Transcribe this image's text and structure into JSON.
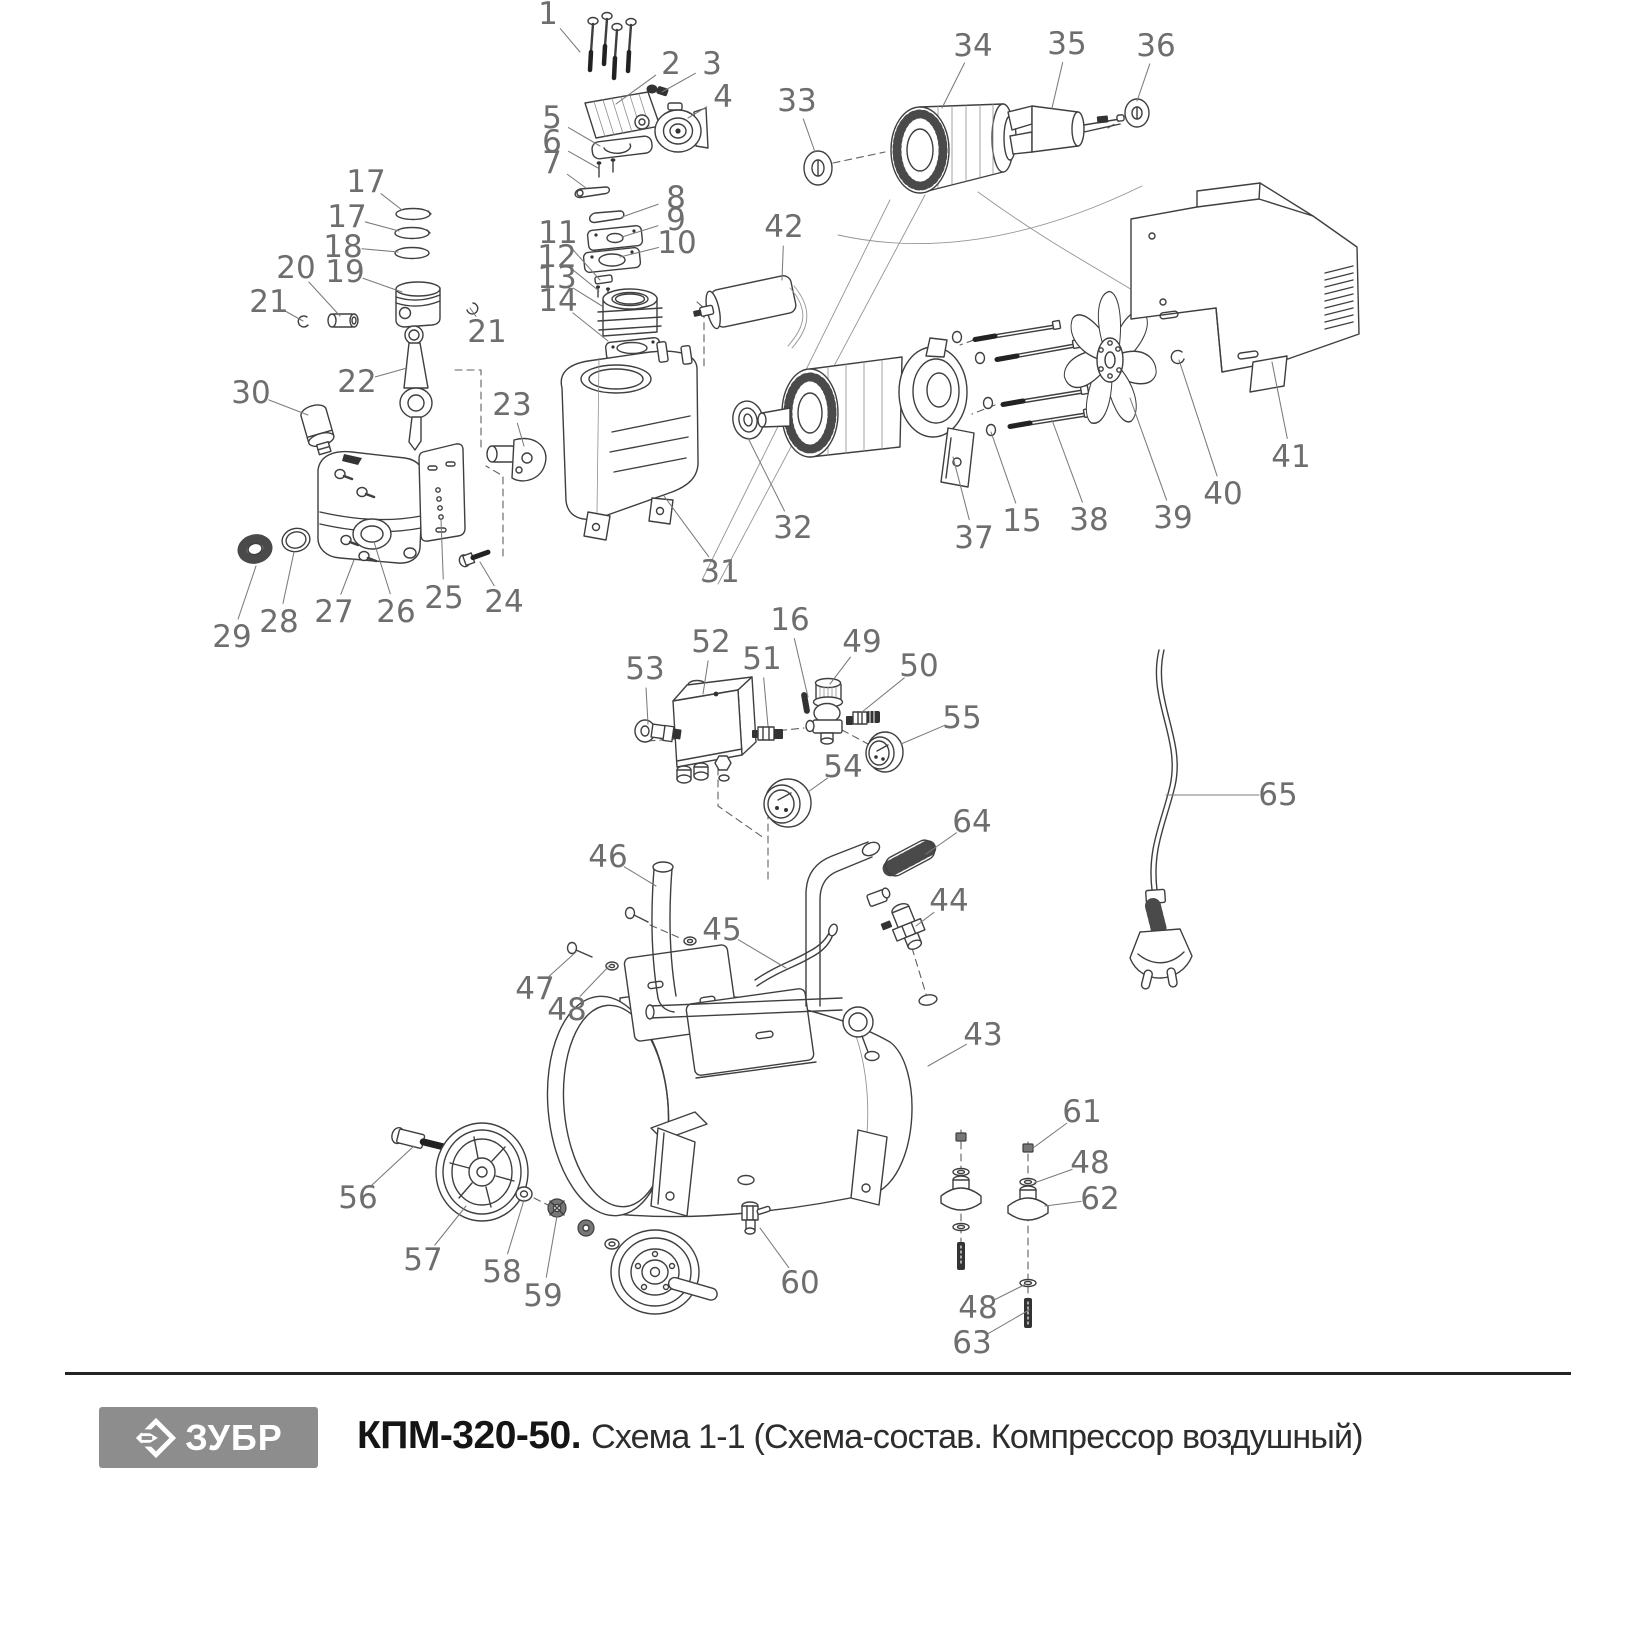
{
  "footer": {
    "brand": "ЗУБР",
    "logo_icon": "zubr-diamond-arrow-icon",
    "model": "КПМ-320-50.",
    "subtitle": "Схема 1-1 (Схема-состав. Компрессор воздушный)"
  },
  "colors": {
    "line_art": "#3f3f3f",
    "label_text": "#6e6e6e",
    "leader_line": "#7b7b7b",
    "logo_background": "#8d8d8d",
    "title_text": "#151515"
  },
  "diagram": {
    "kind": "exploded-parts-diagram",
    "subject": "Компрессор воздушный КПМ-320-50",
    "labels": [
      {
        "t": "1",
        "x": 548,
        "y": 14,
        "tx": 580,
        "ty": 52
      },
      {
        "t": "2",
        "x": 671,
        "y": 64,
        "tx": 616,
        "ty": 104
      },
      {
        "t": "3",
        "x": 712,
        "y": 64,
        "tx": 662,
        "ty": 92
      },
      {
        "t": "4",
        "x": 723,
        "y": 97,
        "tx": 688,
        "ty": 118
      },
      {
        "t": "5",
        "x": 552,
        "y": 118,
        "tx": 600,
        "ty": 146
      },
      {
        "t": "6",
        "x": 552,
        "y": 142,
        "tx": 598,
        "ty": 168
      },
      {
        "t": "7",
        "x": 552,
        "y": 163,
        "tx": 586,
        "ty": 188
      },
      {
        "t": "8",
        "x": 676,
        "y": 198,
        "tx": 622,
        "ty": 217
      },
      {
        "t": "9",
        "x": 676,
        "y": 220,
        "tx": 622,
        "ty": 237
      },
      {
        "t": "10",
        "x": 677,
        "y": 243,
        "tx": 620,
        "ty": 257
      },
      {
        "t": "11",
        "x": 558,
        "y": 233,
        "tx": 600,
        "ty": 280
      },
      {
        "t": "12",
        "x": 557,
        "y": 257,
        "tx": 599,
        "ty": 291
      },
      {
        "t": "13",
        "x": 557,
        "y": 278,
        "tx": 602,
        "ty": 306
      },
      {
        "t": "14",
        "x": 558,
        "y": 301,
        "tx": 608,
        "ty": 341
      },
      {
        "t": "15",
        "x": 1022,
        "y": 521,
        "tx": 991,
        "ty": 432
      },
      {
        "t": "16",
        "x": 790,
        "y": 620,
        "tx": 808,
        "ty": 697
      },
      {
        "t": "17",
        "x": 366,
        "y": 182,
        "tx": 402,
        "ty": 210
      },
      {
        "t": "17",
        "x": 347,
        "y": 217,
        "tx": 399,
        "ty": 231
      },
      {
        "t": "18",
        "x": 343,
        "y": 247,
        "tx": 398,
        "ty": 252
      },
      {
        "t": "19",
        "x": 345,
        "y": 272,
        "tx": 402,
        "ty": 292
      },
      {
        "t": "20",
        "x": 296,
        "y": 268,
        "tx": 340,
        "ty": 316
      },
      {
        "t": "21",
        "x": 269,
        "y": 302,
        "tx": 303,
        "ty": 321
      },
      {
        "t": "21",
        "x": 487,
        "y": 332,
        "tx": 470,
        "ty": 308
      },
      {
        "t": "22",
        "x": 357,
        "y": 382,
        "tx": 407,
        "ty": 368
      },
      {
        "t": "23",
        "x": 512,
        "y": 405,
        "tx": 524,
        "ty": 446
      },
      {
        "t": "24",
        "x": 504,
        "y": 602,
        "tx": 480,
        "ty": 562
      },
      {
        "t": "25",
        "x": 444,
        "y": 598,
        "tx": 441,
        "ty": 520
      },
      {
        "t": "26",
        "x": 396,
        "y": 612,
        "tx": 374,
        "ty": 542
      },
      {
        "t": "27",
        "x": 334,
        "y": 612,
        "tx": 354,
        "ty": 560
      },
      {
        "t": "28",
        "x": 279,
        "y": 622,
        "tx": 294,
        "ty": 552
      },
      {
        "t": "29",
        "x": 232,
        "y": 637,
        "tx": 256,
        "ty": 566
      },
      {
        "t": "30",
        "x": 251,
        "y": 393,
        "tx": 308,
        "ty": 415
      },
      {
        "t": "31",
        "x": 720,
        "y": 572,
        "tx": 664,
        "ty": 496
      },
      {
        "t": "32",
        "x": 793,
        "y": 528,
        "tx": 748,
        "ty": 438
      },
      {
        "t": "33",
        "x": 797,
        "y": 101,
        "tx": 815,
        "ty": 152
      },
      {
        "t": "34",
        "x": 973,
        "y": 46,
        "tx": 942,
        "ty": 108
      },
      {
        "t": "35",
        "x": 1067,
        "y": 44,
        "tx": 1052,
        "ty": 108
      },
      {
        "t": "36",
        "x": 1156,
        "y": 46,
        "tx": 1137,
        "ty": 101
      },
      {
        "t": "37",
        "x": 974,
        "y": 538,
        "tx": 953,
        "ty": 457
      },
      {
        "t": "38",
        "x": 1089,
        "y": 520,
        "tx": 1052,
        "ty": 420
      },
      {
        "t": "39",
        "x": 1173,
        "y": 518,
        "tx": 1130,
        "ty": 398
      },
      {
        "t": "40",
        "x": 1223,
        "y": 494,
        "tx": 1179,
        "ty": 360
      },
      {
        "t": "41",
        "x": 1291,
        "y": 457,
        "tx": 1272,
        "ty": 362
      },
      {
        "t": "42",
        "x": 784,
        "y": 227,
        "tx": 782,
        "ty": 280
      },
      {
        "t": "43",
        "x": 983,
        "y": 1035,
        "tx": 928,
        "ty": 1066
      },
      {
        "t": "44",
        "x": 949,
        "y": 901,
        "tx": 916,
        "ty": 926
      },
      {
        "t": "45",
        "x": 722,
        "y": 930,
        "tx": 786,
        "ty": 968
      },
      {
        "t": "46",
        "x": 608,
        "y": 857,
        "tx": 656,
        "ty": 886
      },
      {
        "t": "47",
        "x": 535,
        "y": 989,
        "tx": 576,
        "ty": 952
      },
      {
        "t": "48",
        "x": 567,
        "y": 1010,
        "tx": 610,
        "ty": 965
      },
      {
        "t": "49",
        "x": 862,
        "y": 642,
        "tx": 830,
        "ty": 684
      },
      {
        "t": "50",
        "x": 919,
        "y": 666,
        "tx": 862,
        "ty": 712
      },
      {
        "t": "51",
        "x": 762,
        "y": 659,
        "tx": 768,
        "ty": 726
      },
      {
        "t": "52",
        "x": 711,
        "y": 642,
        "tx": 703,
        "ty": 694
      },
      {
        "t": "53",
        "x": 645,
        "y": 669,
        "tx": 648,
        "ty": 724
      },
      {
        "t": "54",
        "x": 843,
        "y": 767,
        "tx": 808,
        "ty": 792
      },
      {
        "t": "55",
        "x": 962,
        "y": 718,
        "tx": 901,
        "ty": 744
      },
      {
        "t": "56",
        "x": 358,
        "y": 1198,
        "tx": 414,
        "ty": 1146
      },
      {
        "t": "57",
        "x": 423,
        "y": 1260,
        "tx": 466,
        "ty": 1206
      },
      {
        "t": "58",
        "x": 502,
        "y": 1272,
        "tx": 524,
        "ty": 1200
      },
      {
        "t": "59",
        "x": 543,
        "y": 1296,
        "tx": 557,
        "ty": 1216
      },
      {
        "t": "60",
        "x": 800,
        "y": 1283,
        "tx": 760,
        "ty": 1228
      },
      {
        "t": "61",
        "x": 1082,
        "y": 1112,
        "tx": 1033,
        "ty": 1148
      },
      {
        "t": "48",
        "x": 1090,
        "y": 1163,
        "tx": 1034,
        "ty": 1183
      },
      {
        "t": "62",
        "x": 1100,
        "y": 1199,
        "tx": 1045,
        "ty": 1206
      },
      {
        "t": "48",
        "x": 978,
        "y": 1308,
        "tx": 1026,
        "ty": 1284
      },
      {
        "t": "63",
        "x": 972,
        "y": 1343,
        "tx": 1029,
        "ty": 1310
      },
      {
        "t": "64",
        "x": 972,
        "y": 822,
        "tx": 926,
        "ty": 854
      },
      {
        "t": "65",
        "x": 1278,
        "y": 795,
        "tx": 1166,
        "ty": 795
      }
    ]
  }
}
